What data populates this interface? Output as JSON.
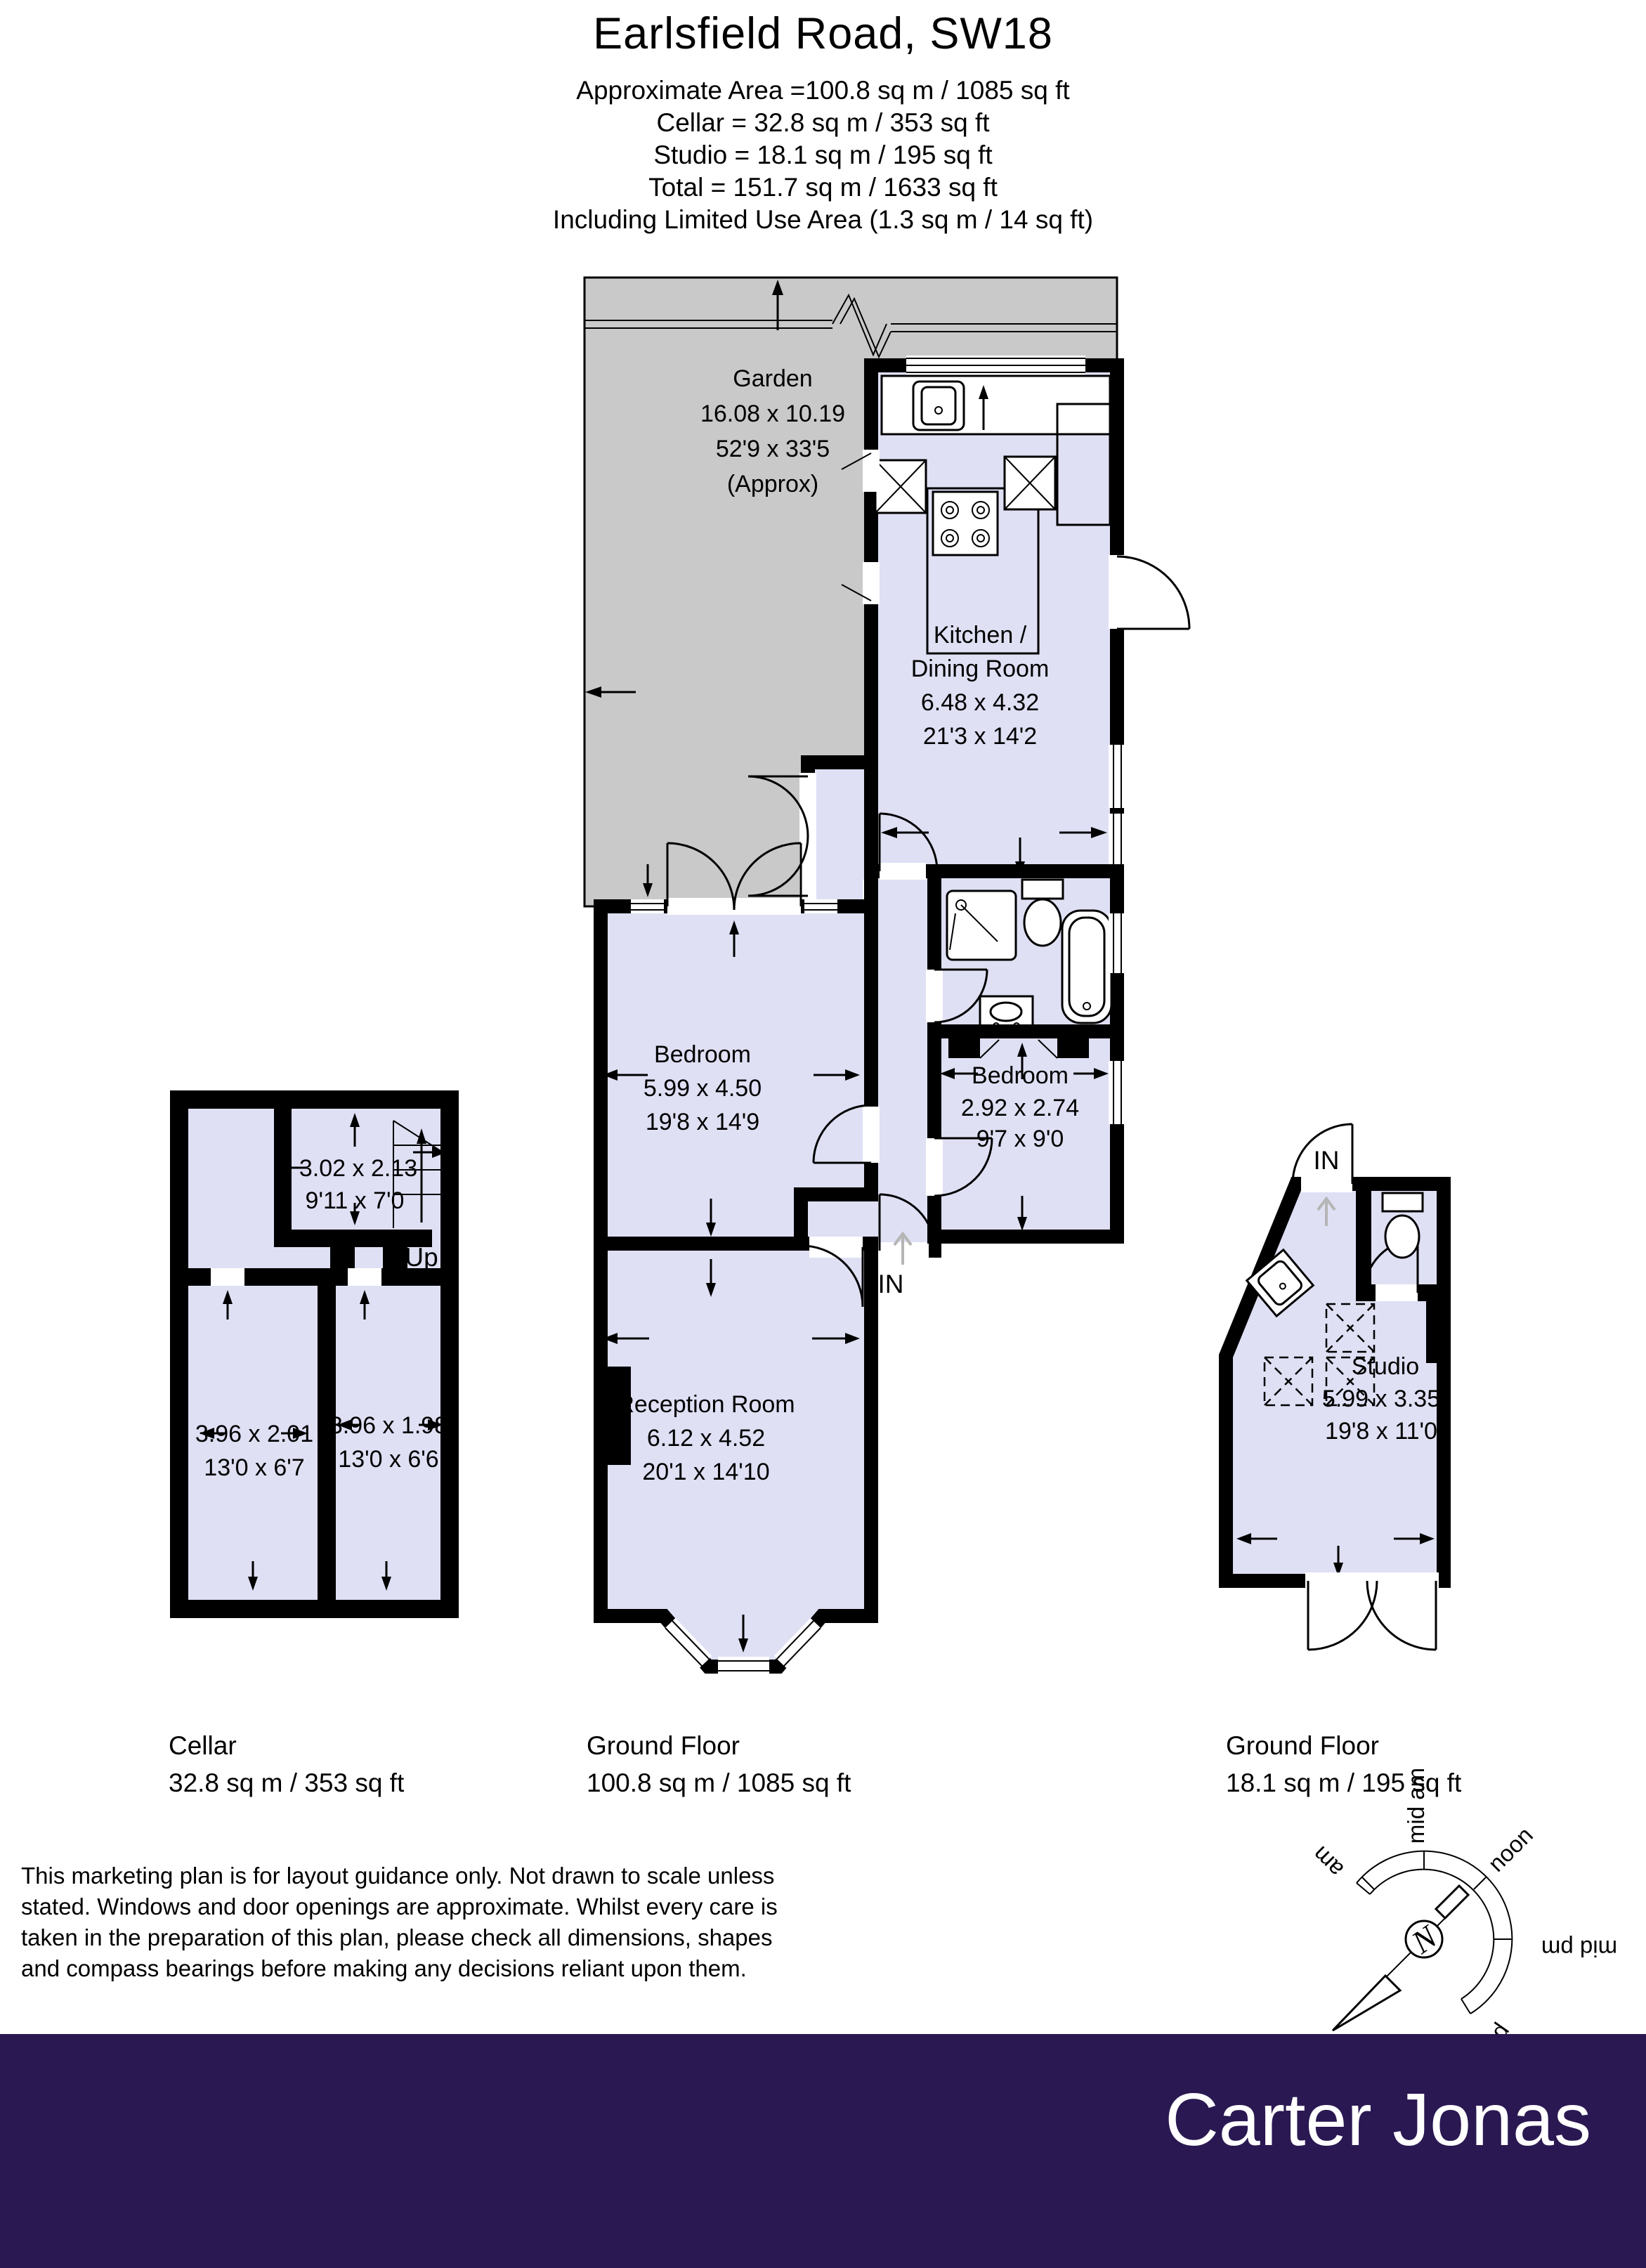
{
  "header": {
    "title": "Earlsfield Road, SW18",
    "lines": [
      "Approximate Area =100.8 sq m / 1085 sq ft",
      "Cellar = 32.8 sq m / 353 sq ft",
      "Studio  = 18.1 sq m / 195 sq ft",
      "Total  = 151.7 sq m / 1633 sq ft",
      "Including Limited Use Area (1.3 sq m / 14 sq ft)"
    ]
  },
  "garden": {
    "name": "Garden",
    "dim_m": "16.08 x 10.19",
    "dim_ft": "52'9 x 33'5",
    "approx": "(Approx)"
  },
  "rooms": {
    "kitchen": {
      "name1": "Kitchen /",
      "name2": "Dining Room",
      "dim_m": "6.48 x 4.32",
      "dim_ft": "21'3 x 14'2"
    },
    "bedroom1": {
      "name": "Bedroom",
      "dim_m": "5.99 x 4.50",
      "dim_ft": "19'8 x 14'9"
    },
    "bedroom2": {
      "name": "Bedroom",
      "dim_m": "2.92 x 2.74",
      "dim_ft": "9'7 x 9'0"
    },
    "reception": {
      "name": "Reception Room",
      "dim_m": "6.12 x 4.52",
      "dim_ft": "20'1 x 14'10"
    },
    "studio": {
      "name": "Studio",
      "dim_m": "5.99 x 3.35",
      "dim_ft": "19'8 x 11'0"
    },
    "cellar_top": {
      "dim_m": "3.02 x 2.13",
      "dim_ft": "9'11 x 7'0"
    },
    "cellar_left": {
      "dim_m": "3.96 x 2.01",
      "dim_ft": "13'0 x 6'7"
    },
    "cellar_right": {
      "dim_m": "3.96 x 1.98",
      "dim_ft": "13'0 x 6'6"
    }
  },
  "annotations": {
    "in_label": "IN",
    "up_label": "Up"
  },
  "floors": [
    {
      "label": "Cellar",
      "area": "32.8 sq m / 353 sq ft"
    },
    {
      "label": "Ground Floor",
      "area": "100.8 sq m / 1085 sq ft"
    },
    {
      "label": "Ground Floor",
      "area": "18.1 sq m / 195 sq ft"
    }
  ],
  "disclaimer": {
    "lines": [
      "This marketing plan is for layout guidance only. Not drawn to scale unless",
      "stated. Windows and door openings are approximate. Whilst every care is",
      "taken in the preparation of this plan, please check all dimensions, shapes",
      "and compass bearings before making any decisions reliant upon them."
    ]
  },
  "compass": {
    "north": "N",
    "labels": [
      "am",
      "mid am",
      "noon",
      "mid pm",
      "pm"
    ]
  },
  "footer": {
    "brand": "Carter Jonas"
  },
  "colors": {
    "room": "#dfe0f4",
    "garden": "#c9c9c9",
    "wall": "#000000",
    "footer": "#2a1852"
  }
}
